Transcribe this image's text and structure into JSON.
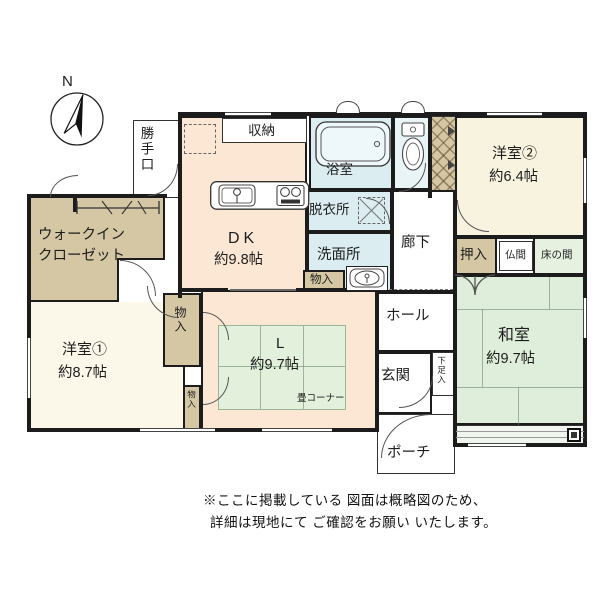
{
  "compass": {
    "label": "N"
  },
  "rooms": {
    "dk": {
      "name": "DK",
      "size": "約9.8帖"
    },
    "living": {
      "name": "L",
      "size": "約9.7帖",
      "tatami_corner": "畳コーナー"
    },
    "washitsu": {
      "name": "和室",
      "size": "約9.7帖"
    },
    "yoshitsu1": {
      "name": "洋室①",
      "size": "約8.7帖"
    },
    "yoshitsu2": {
      "name": "洋室②",
      "size": "約6.4帖"
    },
    "wic": {
      "line1": "ウォークイン",
      "line2": "クローゼット"
    },
    "katteguchi": {
      "label": "勝手口"
    },
    "shunou": {
      "label": "収納"
    },
    "yokushitsu": {
      "label": "浴室"
    },
    "datsuijo": {
      "label": "脱衣所"
    },
    "senmenjo": {
      "label": "洗面所"
    },
    "rouka": {
      "label": "廊下"
    },
    "hall": {
      "label": "ホール"
    },
    "genkan": {
      "label": "玄関"
    },
    "gesokuire": {
      "label": "下足入"
    },
    "porch": {
      "label": "ポーチ"
    },
    "oshiire": {
      "label": "押入"
    },
    "butsuma": {
      "label": "仏間"
    },
    "tokonoma": {
      "label": "床の間"
    },
    "monoire_washroom": {
      "label": "物入"
    },
    "monoire_upper": {
      "label": "物入"
    },
    "monoire_lower": {
      "label": "物入"
    }
  },
  "note": {
    "line1": "※ここに掲載している 図面は概略図のため、",
    "line2": "詳細は現地にて ご確認をお願い いたします。"
  },
  "colors": {
    "wall": "#1c1c1c",
    "western_room": "#f8f3df",
    "ldk": "#fbe7d3",
    "closet": "#d5c7a4",
    "wet_area": "#dbedf1",
    "tatami": "#dfeeda",
    "background": "#ffffff"
  }
}
